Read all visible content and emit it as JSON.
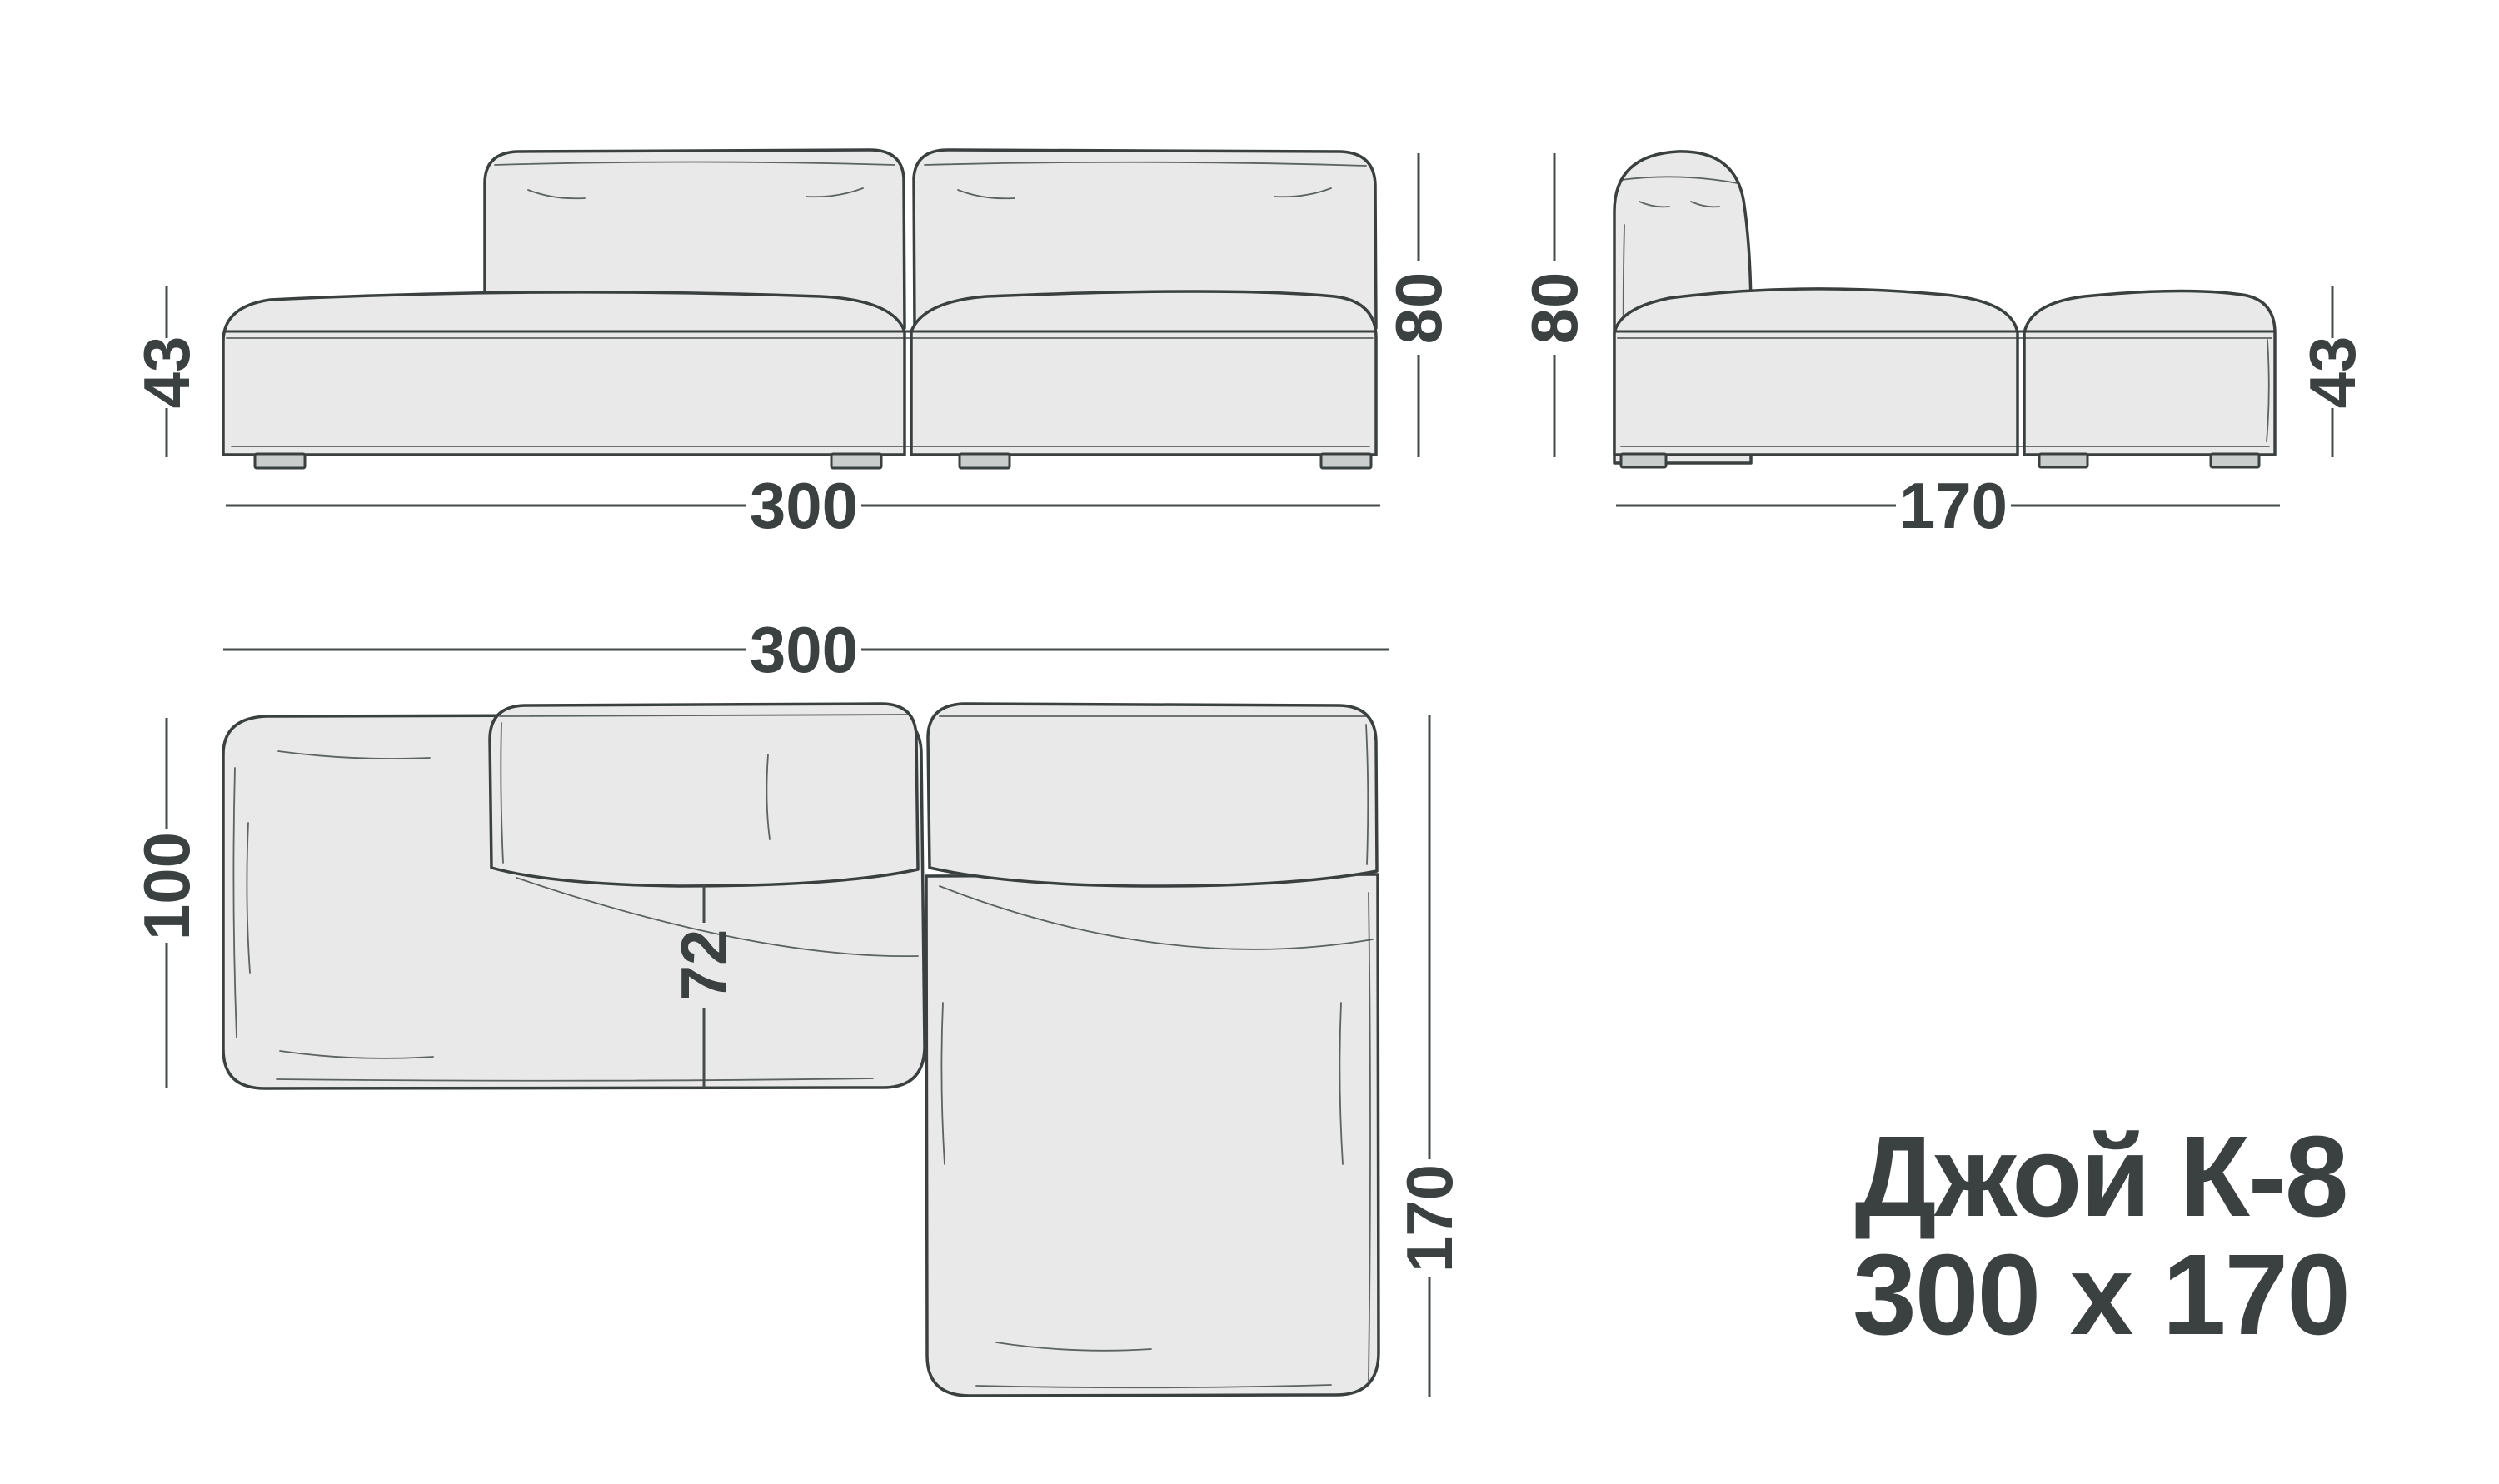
{
  "title": {
    "line1": "Джой К-8",
    "line2": "300 х 170"
  },
  "views": {
    "front": {
      "dim_seat_height": "43",
      "dim_total_height": "80",
      "dim_width": "300"
    },
    "side": {
      "dim_total_height": "80",
      "dim_seat_height": "43",
      "dim_depth": "170"
    },
    "top": {
      "dim_width": "300",
      "dim_left_depth": "100",
      "dim_seat_depth": "72",
      "dim_chaise_depth": "170"
    }
  },
  "colors": {
    "background": "#ffffff",
    "outline": "#3a4040",
    "fill": "#e9e9e9",
    "leg_fill": "#c9cdcc",
    "dim": "#454b4b",
    "text": "#3b4141"
  }
}
